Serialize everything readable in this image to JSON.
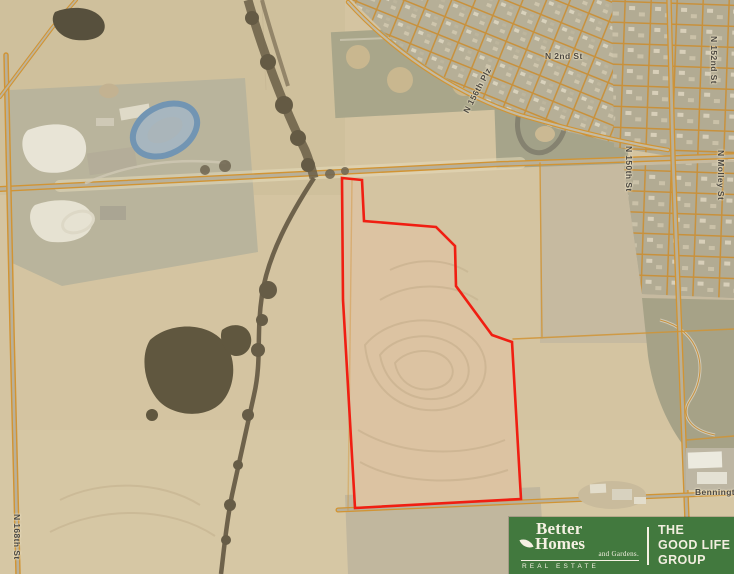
{
  "map": {
    "street_labels": [
      {
        "text": "N 156th Plz",
        "x": 461,
        "y": 110,
        "rotation": -62
      },
      {
        "text": "N 2nd St",
        "x": 545,
        "y": 51,
        "rotation": 0
      },
      {
        "text": "N 150th St",
        "x": 634,
        "y": 146,
        "rotation": 90
      },
      {
        "text": "N 152nd St",
        "x": 719,
        "y": 36,
        "rotation": 90
      },
      {
        "text": "N Molley St",
        "x": 726,
        "y": 150,
        "rotation": 90
      },
      {
        "text": "N 168th St",
        "x": 22,
        "y": 514,
        "rotation": 90
      },
      {
        "text": "Bennington Rd",
        "x": 695,
        "y": 487,
        "rotation": 0
      }
    ],
    "property_boundary": {
      "stroke_color": "#f01e12",
      "points": [
        [
          342,
          178
        ],
        [
          362,
          180
        ],
        [
          364,
          221
        ],
        [
          436,
          227
        ],
        [
          455,
          246
        ],
        [
          456,
          286
        ],
        [
          492,
          335
        ],
        [
          512,
          342
        ],
        [
          521,
          499
        ],
        [
          355,
          508
        ],
        [
          343,
          300
        ]
      ]
    }
  },
  "logo": {
    "background_color": "#42793e",
    "text_color": "#f5f1e3",
    "brand": {
      "word1": "Better",
      "word2": "Homes",
      "word3": "and Gardens.",
      "tagline": "REAL ESTATE"
    },
    "group": {
      "line1": "THE",
      "line2": "GOOD LIFE",
      "line3": "GROUP"
    }
  }
}
